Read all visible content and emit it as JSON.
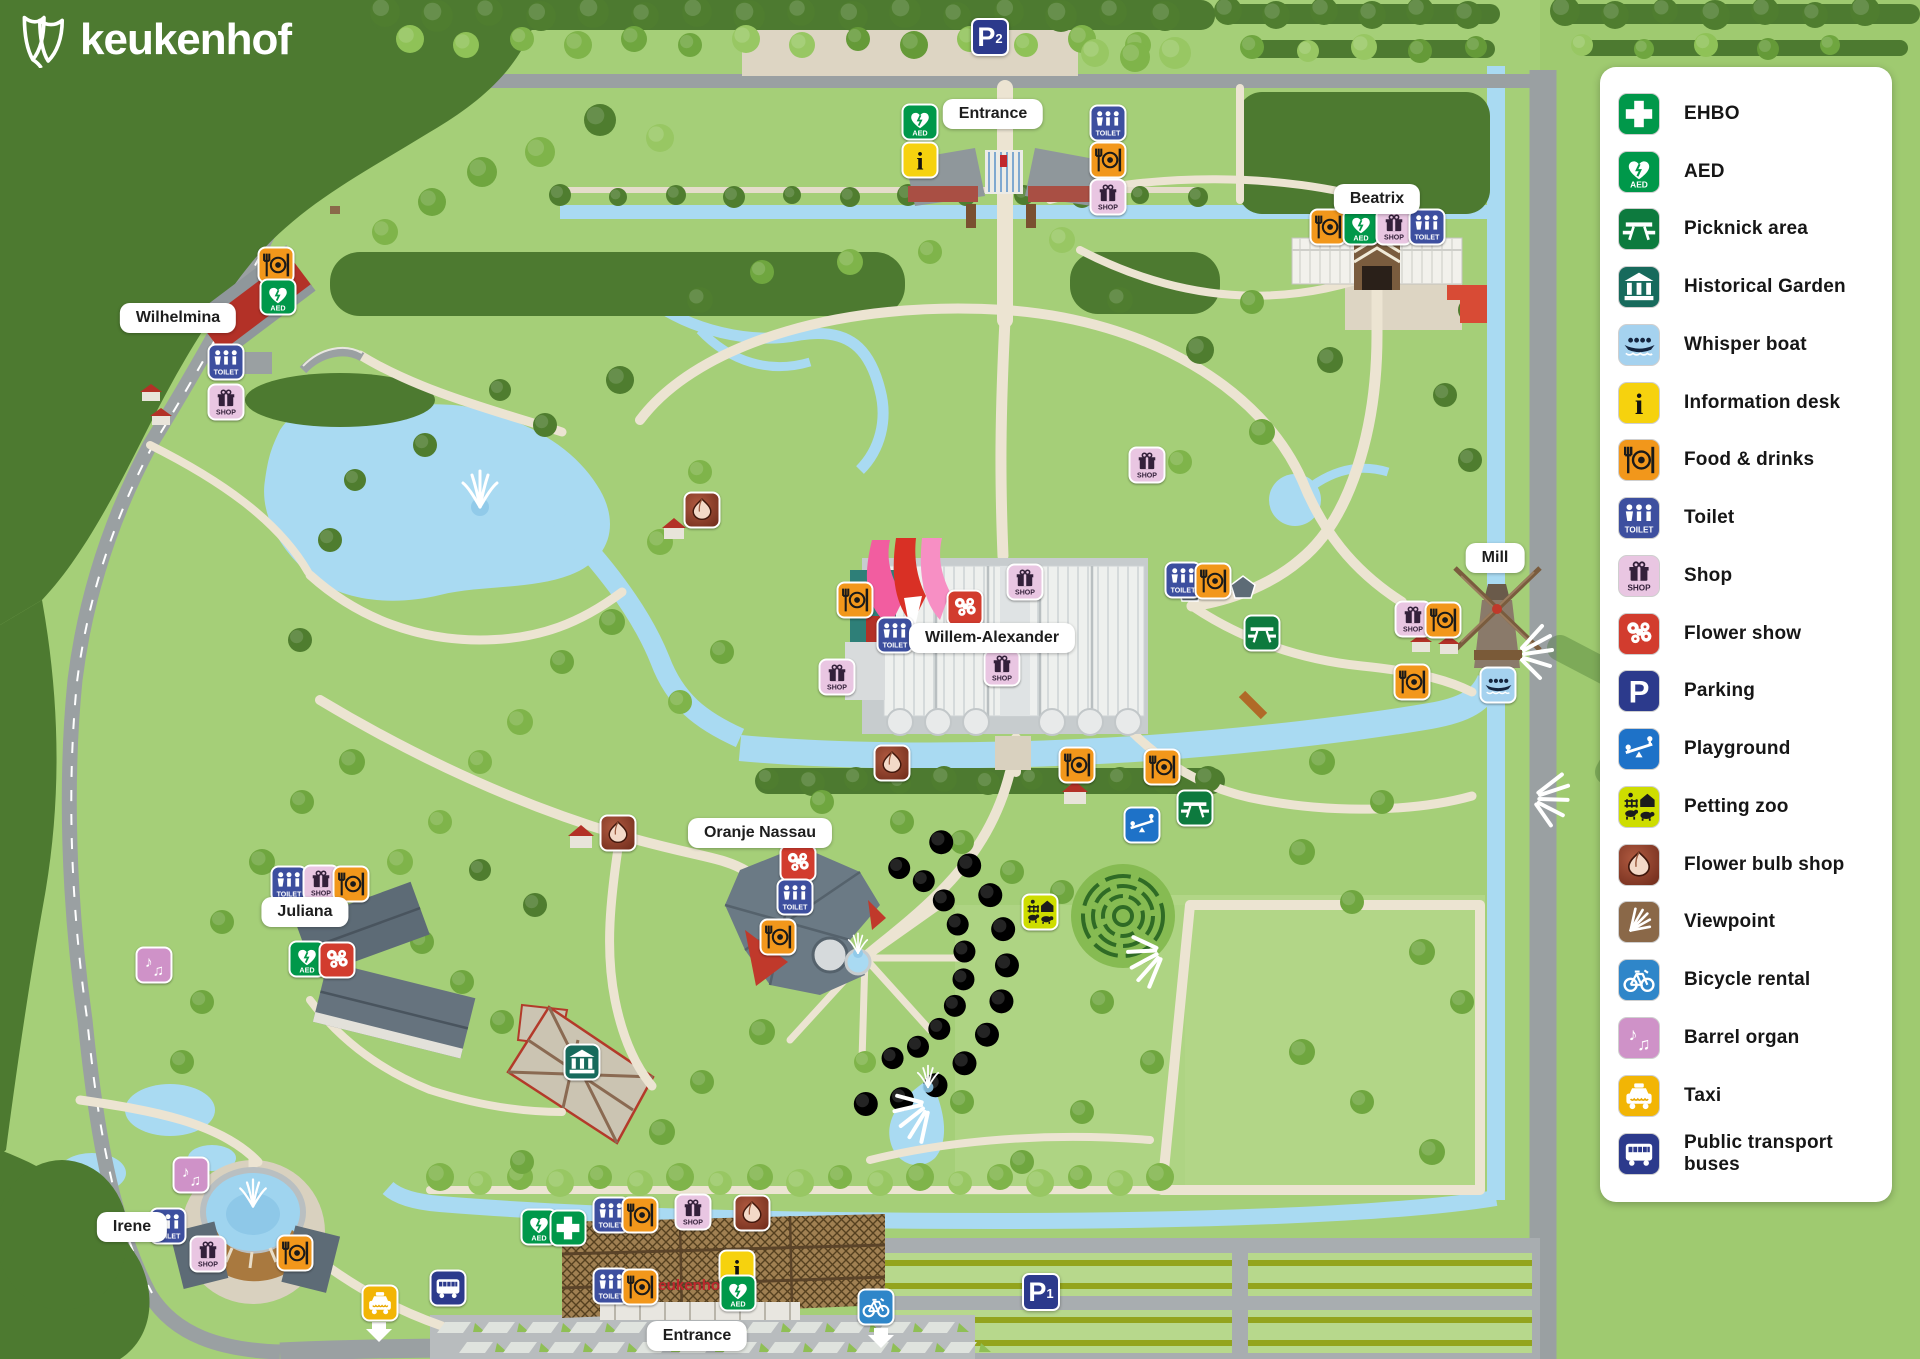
{
  "logo": {
    "text": "keukenhof"
  },
  "legend": {
    "items": [
      {
        "id": "ehbo",
        "label": "EHBO",
        "color": "#00984a"
      },
      {
        "id": "aed",
        "label": "AED",
        "color": "#00984a"
      },
      {
        "id": "picnic",
        "label": "Picknick area",
        "color": "#0d7a3e"
      },
      {
        "id": "historical",
        "label": "Historical Garden",
        "color": "#176a5c"
      },
      {
        "id": "whisperboat",
        "label": "Whisper boat",
        "color": "#a5d2ef"
      },
      {
        "id": "info",
        "label": "Information desk",
        "color": "#f6d20e"
      },
      {
        "id": "food",
        "label": "Food & drinks",
        "color": "#f2971b"
      },
      {
        "id": "toilet",
        "label": "Toilet",
        "color": "#3d4f9f"
      },
      {
        "id": "shop",
        "label": "Shop",
        "color": "#e9c6e2"
      },
      {
        "id": "flowershow",
        "label": "Flower show",
        "color": "#d23c2e"
      },
      {
        "id": "parking",
        "label": "Parking",
        "color": "#2c3a8c"
      },
      {
        "id": "playground",
        "label": "Playground",
        "color": "#1e72c8"
      },
      {
        "id": "pettingzoo",
        "label": "Petting zoo",
        "color": "#cedd00"
      },
      {
        "id": "bulbshop",
        "label": "Flower bulb shop",
        "color": "#96432e"
      },
      {
        "id": "viewpoint",
        "label": "Viewpoint",
        "color": "#8a6848"
      },
      {
        "id": "bicycle",
        "label": "Bicycle rental",
        "color": "#2f86c9"
      },
      {
        "id": "barrelorgan",
        "label": "Barrel organ",
        "color": "#cf92c8"
      },
      {
        "id": "taxi",
        "label": "Taxi",
        "color": "#f2b505"
      },
      {
        "id": "bus",
        "label": "Public transport buses",
        "color": "#2c3a8c"
      }
    ]
  },
  "map": {
    "building_text": "keukenhof",
    "labels": [
      {
        "id": "entrance-top",
        "text": "Entrance",
        "x": 993,
        "y": 114
      },
      {
        "id": "beatrix",
        "text": "Beatrix",
        "x": 1377,
        "y": 199
      },
      {
        "id": "wilhelmina",
        "text": "Wilhelmina",
        "x": 178,
        "y": 318
      },
      {
        "id": "mill",
        "text": "Mill",
        "x": 1495,
        "y": 558
      },
      {
        "id": "willem-alexander",
        "text": "Willem-Alexander",
        "x": 992,
        "y": 638
      },
      {
        "id": "oranje-nassau",
        "text": "Oranje Nassau",
        "x": 760,
        "y": 833
      },
      {
        "id": "juliana",
        "text": "Juliana",
        "x": 305,
        "y": 912
      },
      {
        "id": "irene",
        "text": "Irene",
        "x": 132,
        "y": 1227
      },
      {
        "id": "entrance-bottom",
        "text": "Entrance",
        "x": 697,
        "y": 1336
      }
    ],
    "parking_signs": [
      {
        "id": "p2",
        "text": "P",
        "sub": "2",
        "x": 990,
        "y": 37
      },
      {
        "id": "p1",
        "text": "P",
        "sub": "1",
        "x": 1041,
        "y": 1292
      }
    ],
    "markers": [
      {
        "type": "aed",
        "x": 920,
        "y": 122
      },
      {
        "type": "info",
        "x": 920,
        "y": 160
      },
      {
        "type": "toilet",
        "x": 1108,
        "y": 123
      },
      {
        "type": "food",
        "x": 1108,
        "y": 160
      },
      {
        "type": "shop",
        "x": 1108,
        "y": 197
      },
      {
        "type": "food",
        "x": 1328,
        "y": 227
      },
      {
        "type": "aed",
        "x": 1361,
        "y": 227
      },
      {
        "type": "shop",
        "x": 1394,
        "y": 227
      },
      {
        "type": "toilet",
        "x": 1427,
        "y": 227
      },
      {
        "type": "food",
        "x": 276,
        "y": 265
      },
      {
        "type": "aed",
        "x": 278,
        "y": 297
      },
      {
        "type": "toilet",
        "x": 226,
        "y": 362
      },
      {
        "type": "shop",
        "x": 226,
        "y": 402
      },
      {
        "type": "shop",
        "x": 1147,
        "y": 465
      },
      {
        "type": "bulbshop",
        "x": 702,
        "y": 510
      },
      {
        "type": "toilet",
        "x": 1183,
        "y": 580
      },
      {
        "type": "food",
        "x": 1213,
        "y": 581
      },
      {
        "type": "picnic",
        "x": 1262,
        "y": 633
      },
      {
        "type": "food",
        "x": 855,
        "y": 600
      },
      {
        "type": "toilet",
        "x": 895,
        "y": 635
      },
      {
        "type": "flowershow",
        "x": 965,
        "y": 608
      },
      {
        "type": "shop",
        "x": 1025,
        "y": 582
      },
      {
        "type": "shop",
        "x": 1002,
        "y": 668
      },
      {
        "type": "shop",
        "x": 837,
        "y": 677
      },
      {
        "type": "shop",
        "x": 1413,
        "y": 619
      },
      {
        "type": "food",
        "x": 1443,
        "y": 620
      },
      {
        "type": "food",
        "x": 1412,
        "y": 682
      },
      {
        "type": "whisperboat",
        "x": 1498,
        "y": 685
      },
      {
        "type": "bulbshop",
        "x": 618,
        "y": 833
      },
      {
        "type": "bulbshop",
        "x": 892,
        "y": 763
      },
      {
        "type": "food",
        "x": 1077,
        "y": 765
      },
      {
        "type": "food",
        "x": 1162,
        "y": 767
      },
      {
        "type": "picnic",
        "x": 1195,
        "y": 808
      },
      {
        "type": "playground",
        "x": 1142,
        "y": 825
      },
      {
        "type": "flowershow",
        "x": 798,
        "y": 863
      },
      {
        "type": "toilet",
        "x": 795,
        "y": 897
      },
      {
        "type": "food",
        "x": 778,
        "y": 937
      },
      {
        "type": "toilet",
        "x": 289,
        "y": 884
      },
      {
        "type": "shop",
        "x": 321,
        "y": 883
      },
      {
        "type": "food",
        "x": 351,
        "y": 884
      },
      {
        "type": "aed",
        "x": 307,
        "y": 959
      },
      {
        "type": "flowershow",
        "x": 337,
        "y": 960
      },
      {
        "type": "pettingzoo",
        "x": 1040,
        "y": 912
      },
      {
        "type": "barrelorgan",
        "x": 154,
        "y": 965
      },
      {
        "type": "historical",
        "x": 582,
        "y": 1062
      },
      {
        "type": "barrelorgan",
        "x": 191,
        "y": 1175
      },
      {
        "type": "toilet",
        "x": 168,
        "y": 1226
      },
      {
        "type": "shop",
        "x": 208,
        "y": 1254
      },
      {
        "type": "food",
        "x": 295,
        "y": 1253
      },
      {
        "type": "aed",
        "x": 539,
        "y": 1227
      },
      {
        "type": "ehbo",
        "x": 568,
        "y": 1228
      },
      {
        "type": "toilet",
        "x": 611,
        "y": 1215
      },
      {
        "type": "food",
        "x": 640,
        "y": 1215
      },
      {
        "type": "shop",
        "x": 693,
        "y": 1212
      },
      {
        "type": "bulbshop",
        "x": 752,
        "y": 1213
      },
      {
        "type": "info",
        "x": 737,
        "y": 1268
      },
      {
        "type": "aed",
        "x": 738,
        "y": 1293
      },
      {
        "type": "toilet",
        "x": 611,
        "y": 1286
      },
      {
        "type": "food",
        "x": 640,
        "y": 1287
      },
      {
        "type": "taxi",
        "x": 380,
        "y": 1303
      },
      {
        "type": "bus",
        "x": 448,
        "y": 1288
      },
      {
        "type": "bicycle",
        "x": 876,
        "y": 1307
      }
    ]
  },
  "colors": {
    "base_green": "#a5cf78",
    "forest": "#4d7a30",
    "water": "#a9daf2",
    "path": "#ece4d2",
    "road": "#9aa0a2",
    "panel": "#ffffff"
  }
}
